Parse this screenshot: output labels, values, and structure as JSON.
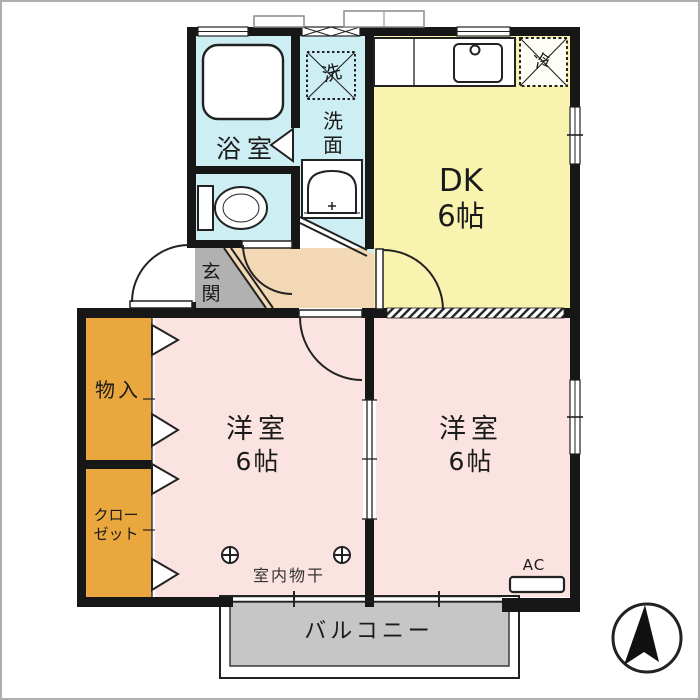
{
  "floorplan": {
    "bathroom": {
      "label": "浴室"
    },
    "washer": {
      "label": "洗"
    },
    "washroom": {
      "chars": [
        "洗",
        "面"
      ]
    },
    "dk": {
      "name": "DK",
      "size": "6帖"
    },
    "fridge": {
      "label": "冷"
    },
    "entrance": {
      "chars": [
        "玄",
        "関"
      ]
    },
    "storage": {
      "label": "物入"
    },
    "closet": {
      "lines": [
        "クロー",
        "ゼット"
      ]
    },
    "bedroom_left": {
      "name": "洋室",
      "size": "6帖"
    },
    "bedroom_right": {
      "name": "洋室",
      "size": "6帖"
    },
    "laundry": {
      "label": "室内物干"
    },
    "ac": {
      "label": "AC"
    },
    "balcony": {
      "label": "バルコニー"
    },
    "colors": {
      "wall": "#1a1a1a",
      "water_rooms": "#cdeef2",
      "dk": "#f8f3ae",
      "bedroom": "#fae3e1",
      "hall": "#f3d8b5",
      "entrance_floor": "#b1b1b1",
      "closet": "#eaa73d",
      "balcony": "#c6c6c6"
    }
  }
}
